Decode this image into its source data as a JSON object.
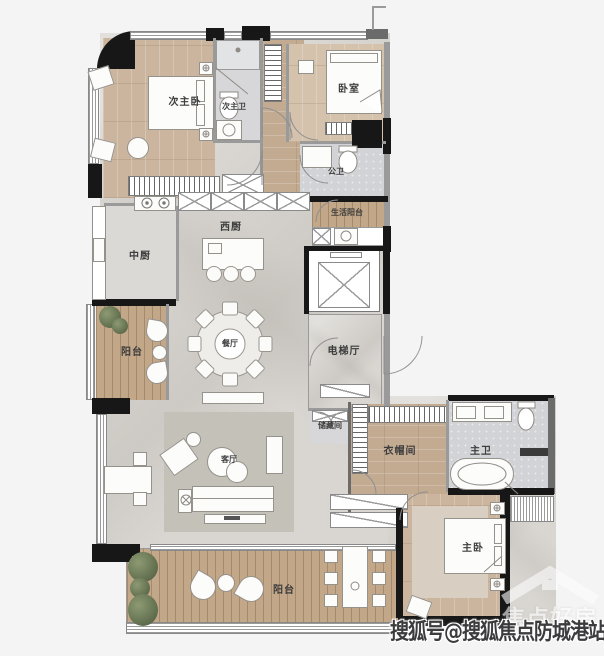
{
  "plan": {
    "rooms": {
      "secondary_master_bedroom": "次主卧",
      "secondary_master_bath": "次主卫",
      "bedroom": "卧室",
      "public_bath": "公卫",
      "service_balcony": "生活阳台",
      "chinese_kitchen": "中厨",
      "western_kitchen": "西厨",
      "balcony_left": "阳台",
      "dining_room": "餐厅",
      "elevator_hall": "电梯厅",
      "storage": "储藏间",
      "living_room": "客厅",
      "walk_in_closet": "衣帽间",
      "master_bath": "主卫",
      "master_bedroom": "主卧",
      "balcony_bottom": "阳台"
    },
    "colors": {
      "background": "#f4f4f5",
      "wall": "#171717",
      "wood_floor": "#ccb59e",
      "deck_floor": "#c2a788",
      "tile_floor": "#d7d7d9",
      "marble_floor": "#d9d6d1"
    }
  },
  "watermark": {
    "text": "搜狐号@搜狐焦点防城港站"
  },
  "logo": {
    "text": "焦点好房"
  }
}
